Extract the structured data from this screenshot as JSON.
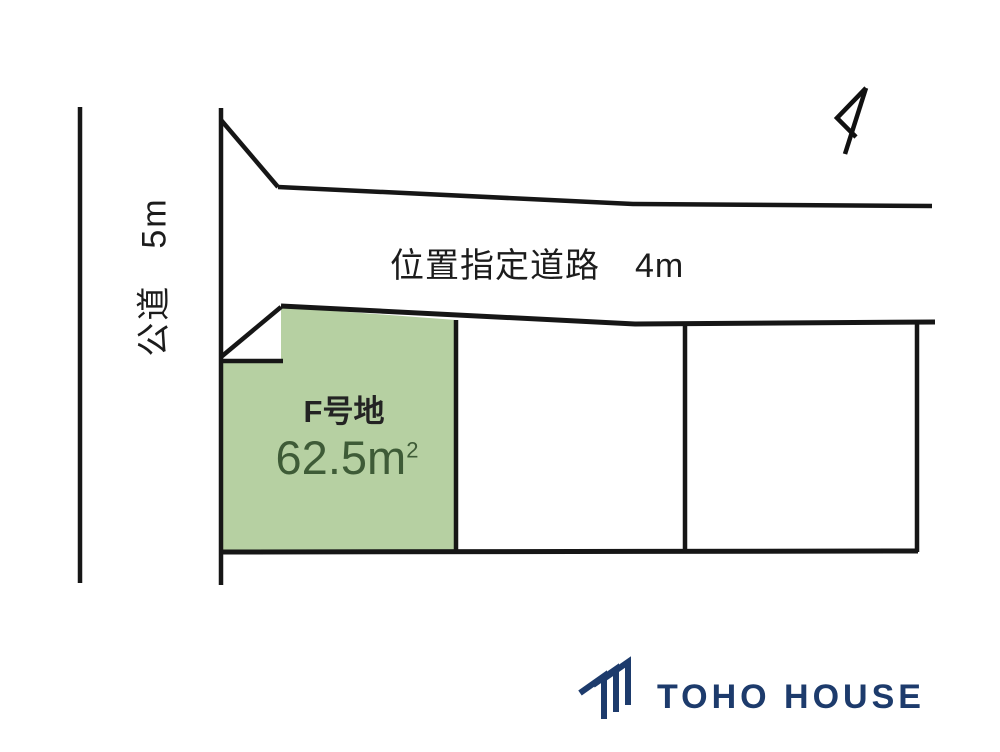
{
  "diagram": {
    "public_road_label": "公道　5m",
    "designated_road_label": "位置指定道路　4m",
    "parcel": {
      "name": "F号地",
      "area": "62.5m",
      "area_sup": "2"
    }
  },
  "colors": {
    "parcel_fill": "#b6d0a2",
    "parcel_area_text": "#3e5b37",
    "boundary_line": "#161616",
    "logo_navy": "#1d3b6c"
  },
  "icons": {
    "north_arrow": "north-arrow-icon",
    "logo_mark": "toho-house-roof-logo-icon"
  },
  "logo": {
    "text": "TOHO HOUSE"
  }
}
